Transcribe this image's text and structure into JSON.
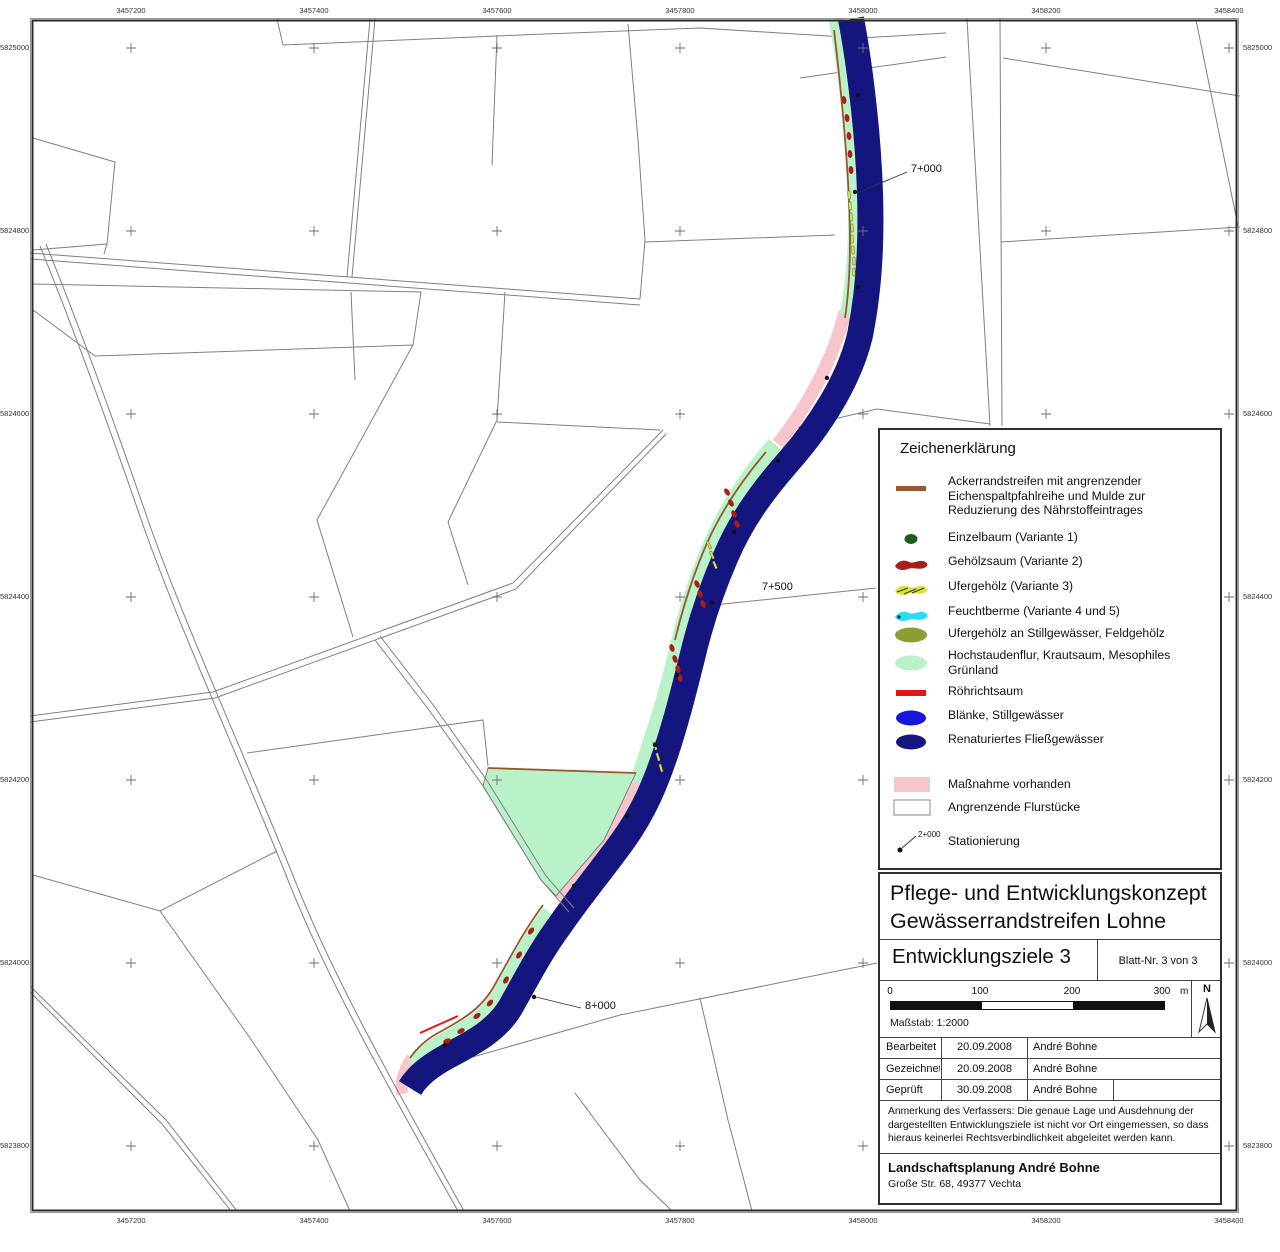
{
  "page": {
    "background": "#ffffff"
  },
  "map": {
    "grid": {
      "x_labels": [
        "3457200",
        "3457400",
        "3457600",
        "3457800",
        "3458000",
        "3458200",
        "3458400"
      ],
      "y_labels": [
        "5825000",
        "5824800",
        "5824600",
        "5824400",
        "5824200",
        "5824000",
        "5823800"
      ]
    },
    "stations": [
      {
        "label": "7+000"
      },
      {
        "label": "7+500"
      },
      {
        "label": "8+000"
      }
    ],
    "colors": {
      "river": "#151580",
      "herb_fringe": "#b9f2c9",
      "measure_existing": "#f7c6cc",
      "parcel_line": "#7f7f7f",
      "acker_brown": "#9a572e",
      "gehoelz_red": "#a81f15",
      "ufergehoelz_yellow": "#dde23a",
      "roehricht_red": "#e81414"
    }
  },
  "legend": {
    "title": "Zeichenerklärung",
    "station_example": "2+000",
    "items": [
      {
        "symbol": "ackerrandstreifen-swatch",
        "color": "#9a572e",
        "label": "Ackerrandstreifen mit angrenzender Eichenspaltpfahlreihe und Mulde zur Reduzierung des Nährstoffeintrages"
      },
      {
        "symbol": "einzelbaum-swatch",
        "color": "#1d5c1d",
        "label": "Einzelbaum (Variante 1)"
      },
      {
        "symbol": "gehoelzsaum-swatch",
        "color": "#a81f15",
        "label": "Gehölzsaum (Variante 2)"
      },
      {
        "symbol": "ufergehoelz-swatch",
        "color": "#dde23a",
        "label": "Ufergehölz (Variante 3)"
      },
      {
        "symbol": "feuchtberme-swatch",
        "color": "#25dff0",
        "label": "Feuchtberme (Variante 4 und 5)"
      },
      {
        "symbol": "ufergehoelz-stillgewaesser-swatch",
        "color": "#8d9c33",
        "label": "Ufergehölz an Stillgewässer, Feldgehölz"
      },
      {
        "symbol": "hochstaudenflur-swatch",
        "color": "#b9f2c9",
        "label": "Hochstaudenflur, Krautsaum, Mesophiles Grünland"
      },
      {
        "symbol": "roehrichtsaum-swatch",
        "color": "#e81414",
        "label": "Röhrichtsaum"
      },
      {
        "symbol": "blaenke-swatch",
        "color": "#1616dd",
        "label": "Blänke, Stillgewässer"
      },
      {
        "symbol": "fliessgewaesser-swatch",
        "color": "#151580",
        "label": "Renaturiertes Fließgewässer"
      },
      {
        "symbol": "massnahme-swatch",
        "color": "#f7c6cc",
        "label": "Maßnahme vorhanden"
      },
      {
        "symbol": "flurstuecke-swatch",
        "color": "#ffffff",
        "label": "Angrenzende Flurstücke"
      },
      {
        "symbol": "stationierung-swatch",
        "color": "#111111",
        "label": "Stationierung"
      }
    ]
  },
  "title_block": {
    "title_line1": "Pflege- und Entwicklungskonzept",
    "title_line2": "Gewässerrandstreifen Lohne",
    "sheet_title": "Entwicklungsziele 3",
    "sheet_no": "Blatt-Nr. 3 von 3",
    "scale": {
      "tick0": "0",
      "tick1": "100",
      "tick2": "200",
      "tick3": "300",
      "unit": "m",
      "label": "Maßstab: 1:2000"
    },
    "north_label": "N",
    "table": [
      {
        "role": "Bearbeitet",
        "date": "20.09.2008",
        "name": "André Bohne"
      },
      {
        "role": "Gezeichnet",
        "date": "20.09.2008",
        "name": "André Bohne"
      },
      {
        "role": "Geprüft",
        "date": "30.09.2008",
        "name": "André Bohne"
      }
    ],
    "note": "Anmerkung des Verfassers: Die genaue Lage und Ausdehnung der dargestellten Entwicklungsziele ist nicht vor Ort eingemessen, so dass hieraus keinerlei Rechtsverbindlichkeit abgeleitet werden kann.",
    "company": "Landschaftsplanung André Bohne",
    "address": "Große Str. 68, 49377 Vechta"
  }
}
